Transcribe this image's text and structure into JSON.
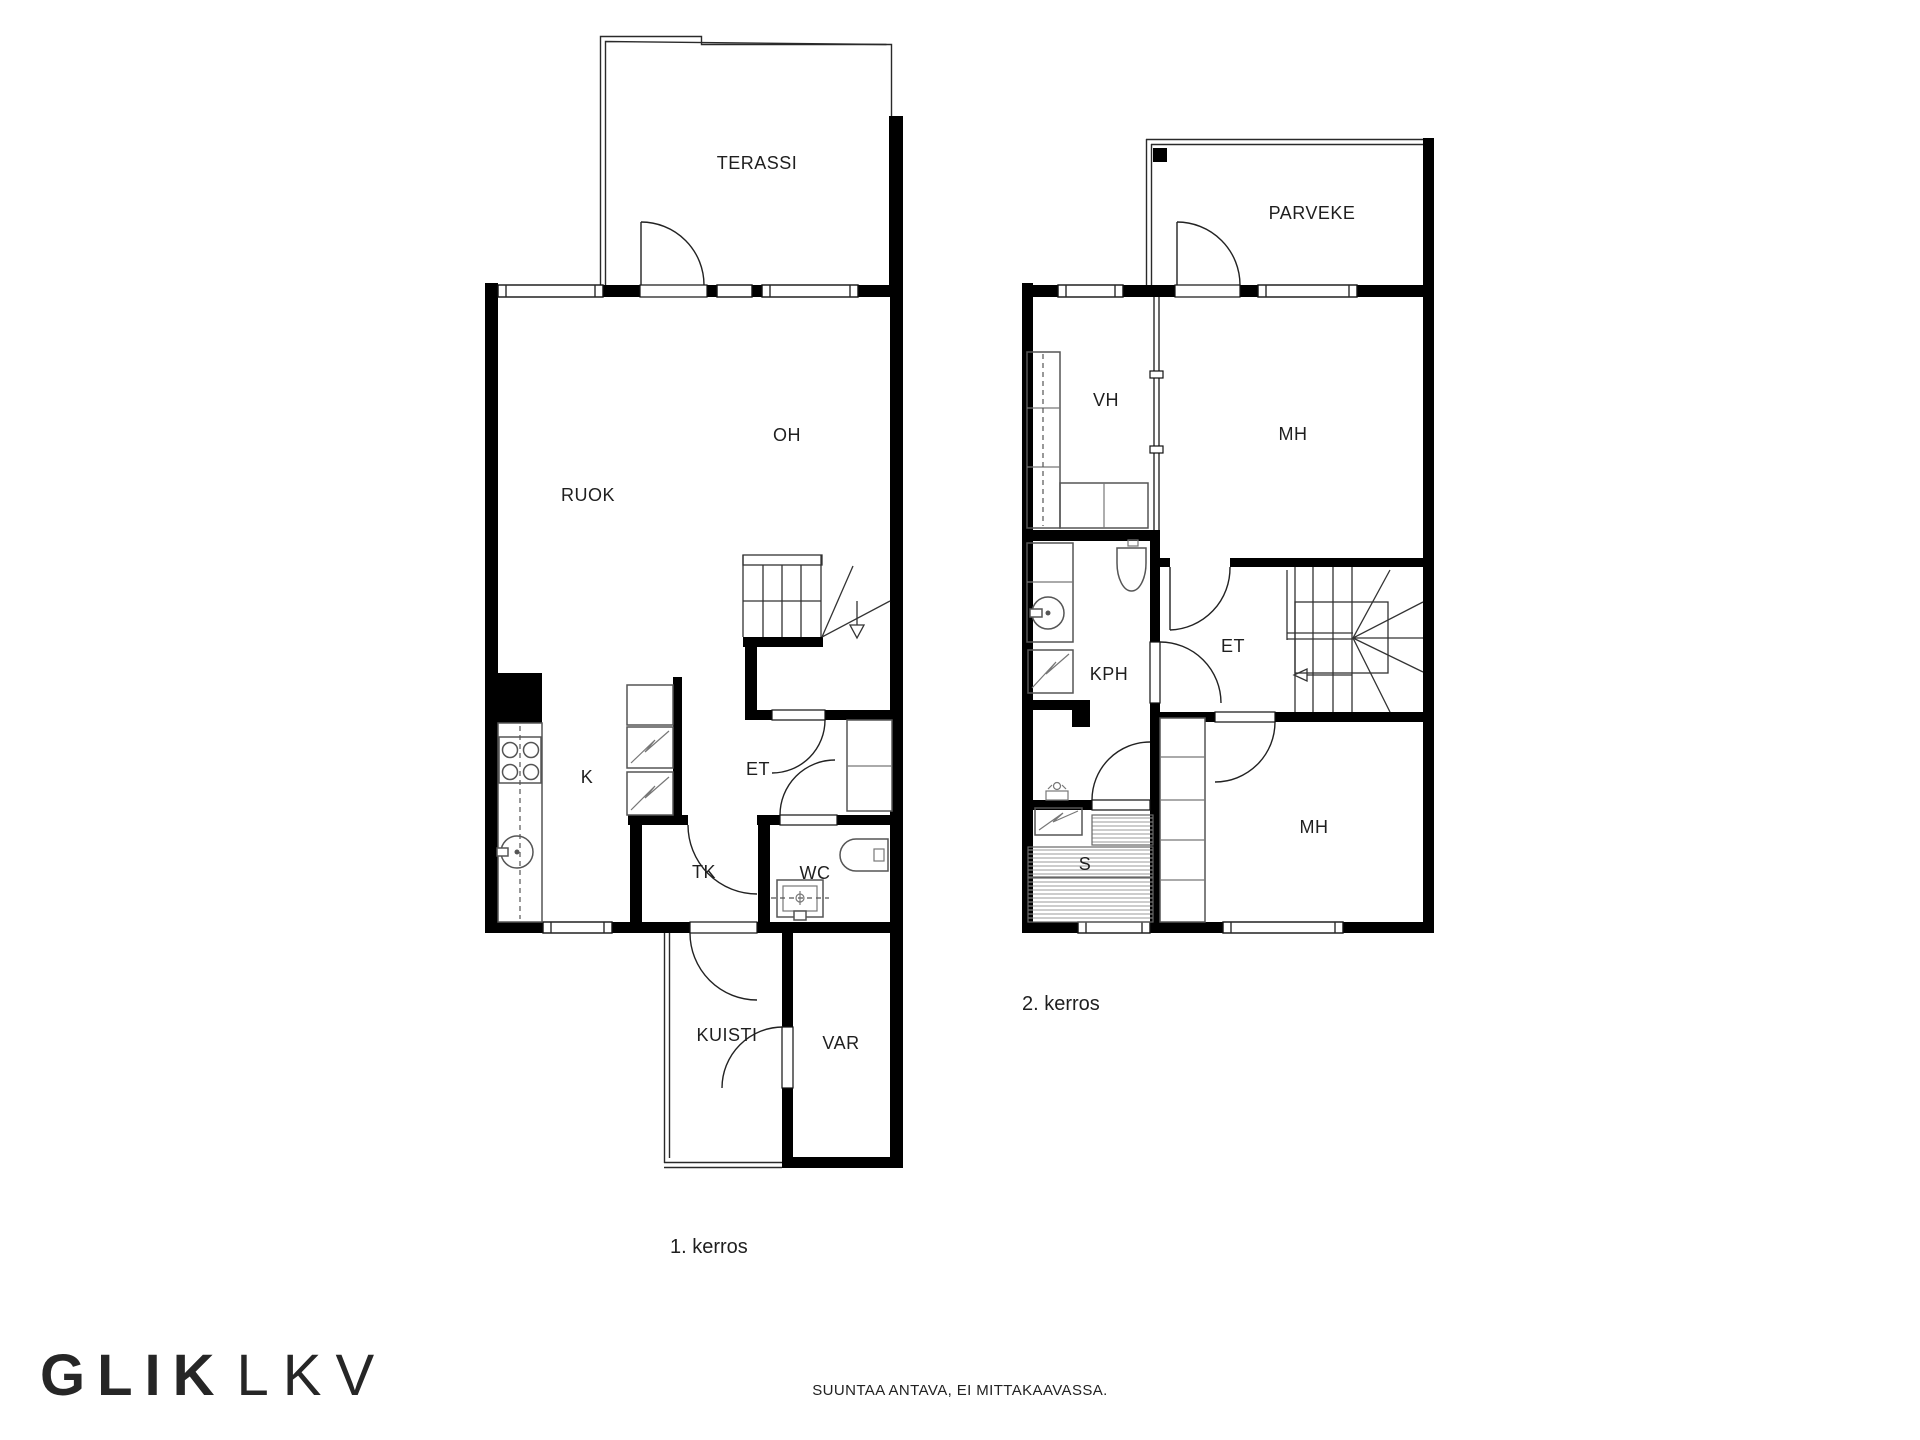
{
  "floor1": {
    "name": "1. kerros",
    "rooms": {
      "terassi": "TERASSI",
      "oh": "OH",
      "ruok": "RUOK",
      "k": "K",
      "et": "ET",
      "tk": "TK",
      "wc": "WC",
      "kuisti": "KUISTI",
      "var": "VAR"
    }
  },
  "floor2": {
    "name": "2. kerros",
    "rooms": {
      "parveke": "PARVEKE",
      "vh": "VH",
      "mh_top": "MH",
      "kph": "KPH",
      "et": "ET",
      "s": "S",
      "mh_bottom": "MH"
    }
  },
  "footer": {
    "brand_bold": "GLIK",
    "brand_light": "LKV",
    "disclaimer": "SUUNTAA ANTAVA, EI MITTAKAAVASSA."
  },
  "colors": {
    "wall": "#000000",
    "background": "#ffffff",
    "fixture_line": "#555555",
    "text": "#1f1f1f"
  }
}
